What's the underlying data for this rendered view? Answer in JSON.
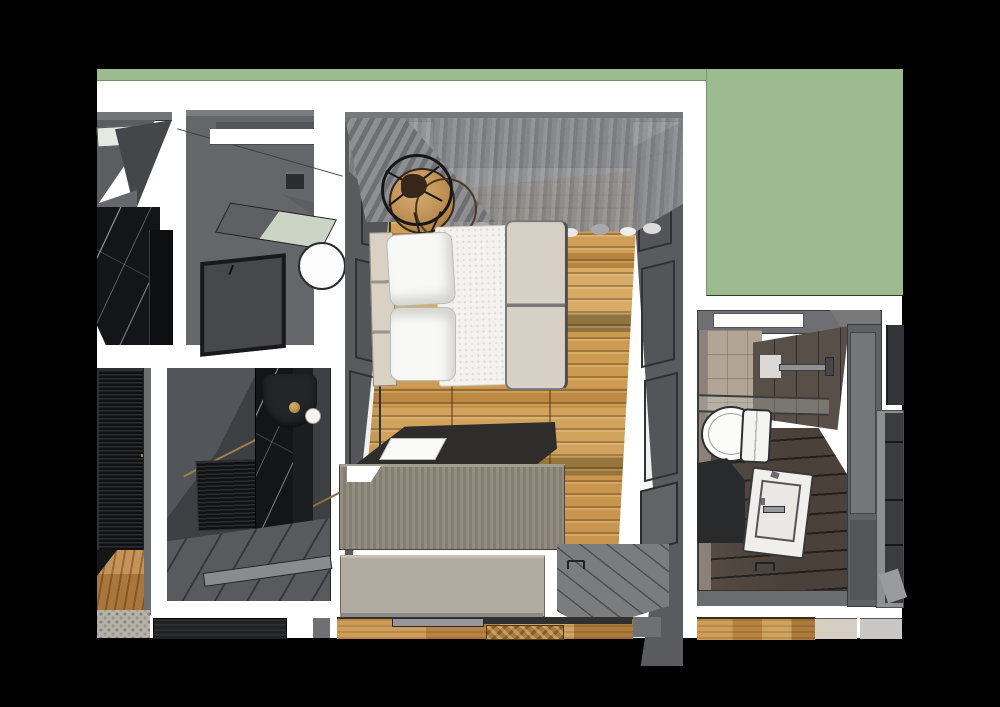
{
  "meta": {
    "view": "top-down 3d interior render of an apartment / hotel suite",
    "style": "sketchup-like architectural rendering, letterboxed on black"
  },
  "colors": {
    "background": "#000000",
    "canvas": "#ffffff",
    "lawn_green": "#9cbb8f",
    "wall_gray": "#5a5b5e",
    "wall_light": "#77787a",
    "wood_floor": "#c69350",
    "bed_white": "#f3f2ee",
    "linen_beige": "#d9d2c4",
    "runner_greige": "#d7d1c5",
    "cabinet_taupe": "#8c8679",
    "slab_black": "#2e2d2b",
    "dresser_beige": "#b2ab9f",
    "marble_black": "#141518",
    "bath_tile": "#b3a595",
    "shower_brown": "#574f48",
    "bath_floor": "#4a413a",
    "brass": "#a08048",
    "glass_green": "#ccd4c6",
    "curtain_gray": "#8a8b8e",
    "mosaic_gray": "#b7b2a8"
  },
  "scene": {
    "rooms": [
      {
        "id": "closet-top-left",
        "label": "Dark marble closet, top left"
      },
      {
        "id": "dressing-room",
        "label": "Dressing room with glass shelf, round mirror and framed mirror"
      },
      {
        "id": "louver-closet",
        "label": "Louvered wardrobe strip with wood and mosaic floor, bottom left"
      },
      {
        "id": "dark-ensuite",
        "label": "Dark ensuite with brass trim, marble column and basin with gold knob"
      },
      {
        "id": "bedroom",
        "label": "Bedroom: sheer curtains over window, round lamp table, double bed with white duvet, beige headboard cushions and greige foot runner, wood plank floor, paneled gray walls, taupe media cabinet with black stone top, entry threshold",
        "objects": [
          "sheer-curtains",
          "window",
          "round-side-table",
          "table-lamp",
          "bed",
          "pillows",
          "headboard-cushions",
          "duvet",
          "foot-runner",
          "wood-plank-floor",
          "paneled-wall-left",
          "paneled-wall-right",
          "media-cabinet",
          "black-stone-top",
          "door-threshold"
        ]
      },
      {
        "id": "bathroom",
        "label": "Bathroom: rain shower arm on dark paneled wall, beige tile, glass screen, toilet, black counter, white door with lever handle, dark plank floor",
        "objects": [
          "shower-plate",
          "shower-arm",
          "glass-screen",
          "toilet",
          "black-counter",
          "white-door",
          "door-handle",
          "plank-floor",
          "light-niche"
        ]
      },
      {
        "id": "wardrobe-right",
        "label": "Right-edge wardrobe shelving, partially cropped"
      },
      {
        "id": "lawn",
        "label": "Green lawn / terrace band and block, top right"
      },
      {
        "id": "hall-console",
        "label": "Beige dresser and wood console strip below bedroom"
      }
    ]
  }
}
